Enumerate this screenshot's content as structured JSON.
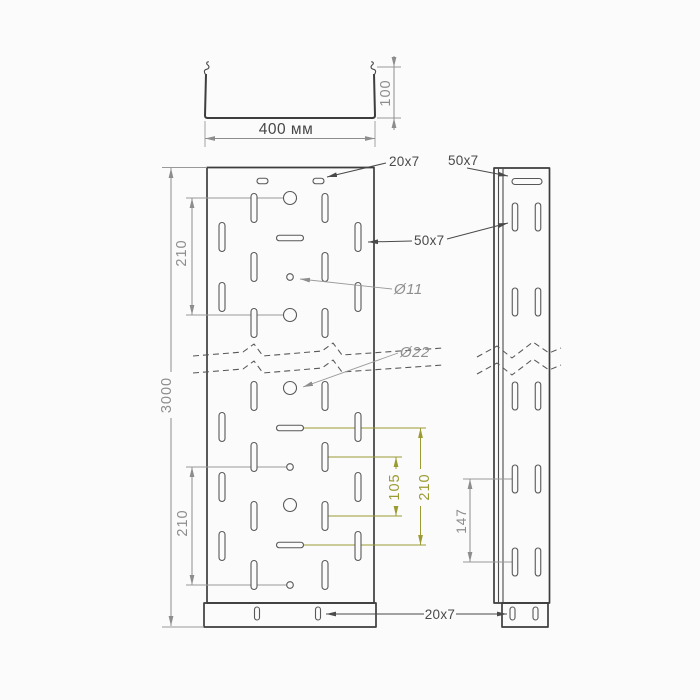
{
  "drawing": {
    "section": {
      "width": "400 мм",
      "height": "100"
    },
    "front": {
      "length": "3000",
      "pitch_upper": "210",
      "pitch_lower": "210",
      "top_slot": "20x7",
      "wall_slot": "50x7",
      "small_hole": "Ø11",
      "large_hole": "Ø22",
      "slot_pitch": "105",
      "slot_group_pitch": "210",
      "flange_slot": "20x7"
    },
    "side": {
      "top_slot": "50x7",
      "slot_pitch": "147"
    }
  }
}
